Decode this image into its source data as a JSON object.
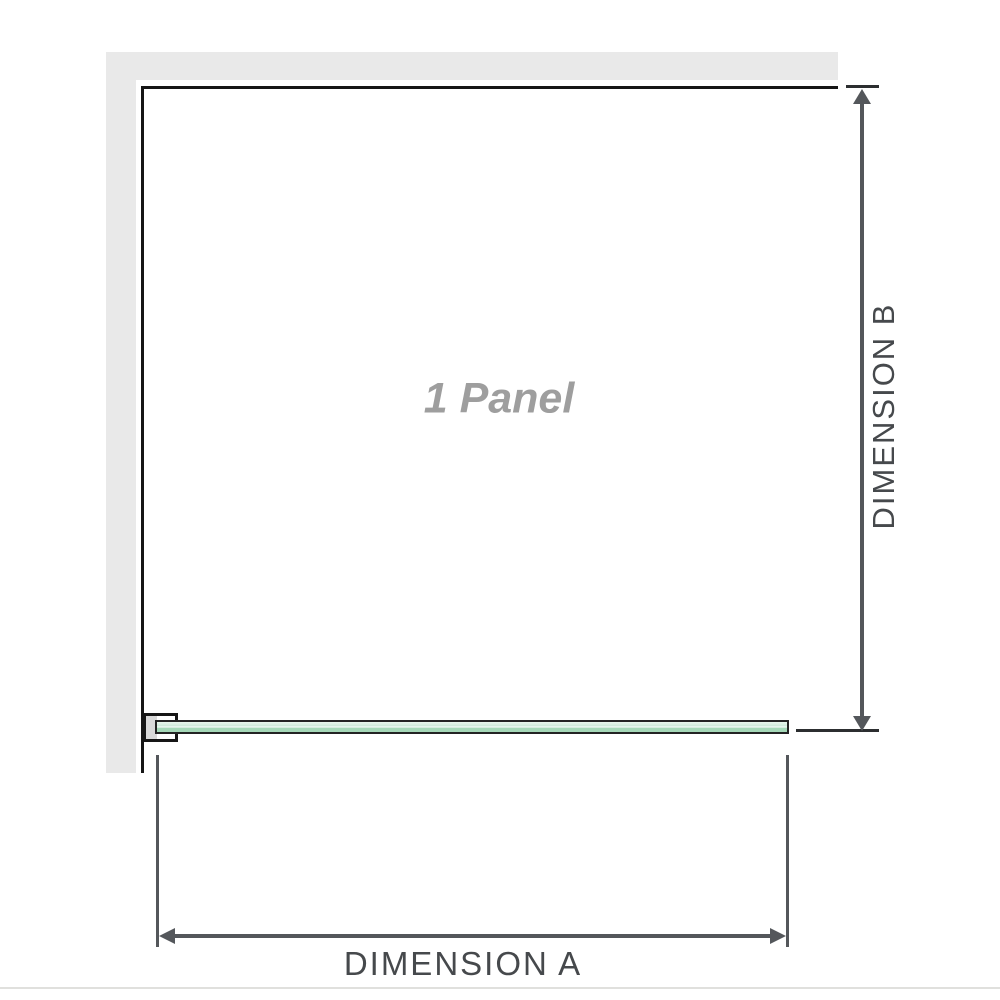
{
  "diagram": {
    "panel_label": "1 Panel",
    "dimension_a_label": "DIMENSION A",
    "dimension_b_label": "DIMENSION B"
  },
  "colors": {
    "wall": "#e9e9e9",
    "wall_outline": "#161616",
    "bracket_fill": "#d9d9d9",
    "glass_border": "#232323",
    "glass_light": "#e9f6ee",
    "glass_mid": "#cfeadb",
    "glass_sheen": "#f7fcf9",
    "glass_dark": "#a5d8b8",
    "dimension_line": "#54575b",
    "tick": "#2c2e30",
    "label_text": "#46494c",
    "panel_text": "#9e9e9e",
    "divider": "#e0e0dd"
  }
}
